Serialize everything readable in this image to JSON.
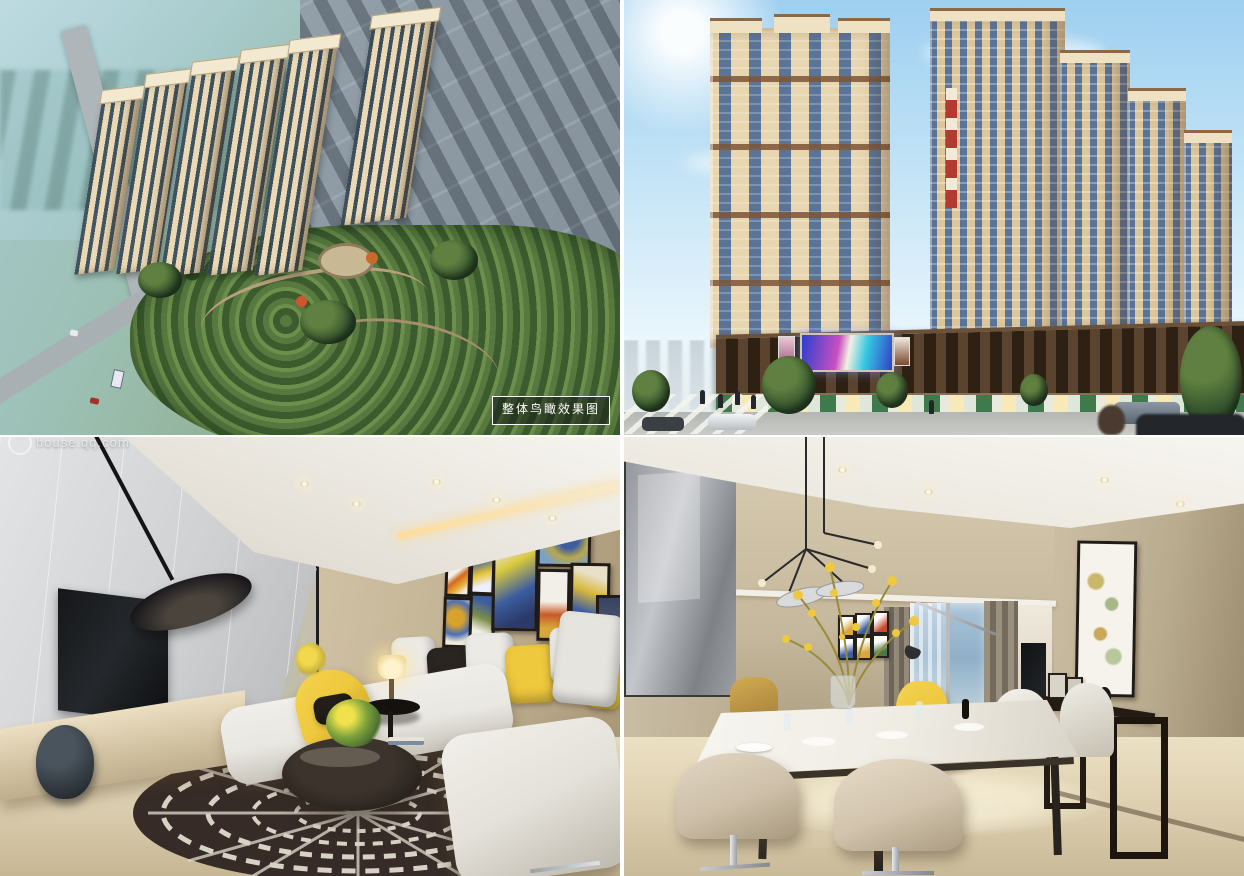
{
  "collage": {
    "panels": [
      {
        "id": "aerial-overview"
      },
      {
        "id": "street-elevation"
      },
      {
        "id": "living-room"
      },
      {
        "id": "dining-room"
      }
    ],
    "aerial_label": "整体鸟瞰效果图",
    "watermark": {
      "logo": "qq-house-logo",
      "text": "house.qq.com"
    }
  },
  "colors": {
    "sky_top": "#9ecff0",
    "sky_low": "#eaf6fc",
    "facade_cream": "#e7d6b0",
    "facade_tan": "#dcc79c",
    "window_blue": "#5a7498",
    "trim_brown": "#7c5436",
    "podium_brown": "#3a2a1b",
    "awning_green": "#3e7a4c",
    "street_gray": "#b7bab6",
    "haze_aqua": "#a9ccd3",
    "lowrise_gray": "#8a96a0",
    "park_green": "#4e6b38",
    "wall_gray": "#d2d3d5",
    "wall_beige": "#c9bda2",
    "corridor_warm": "#c59a6b",
    "floor_beige": "#ddd0b2",
    "sofa_white": "#e9e7e2",
    "accent_yellow": "#eec83d",
    "pillow_black": "#2b2521",
    "rug_dark": "#362b26",
    "led_blue": "#2b3fd0",
    "led_magenta": "#c94fc0",
    "led_cyan": "#35c8e2",
    "red_sign": "#b23a30"
  }
}
